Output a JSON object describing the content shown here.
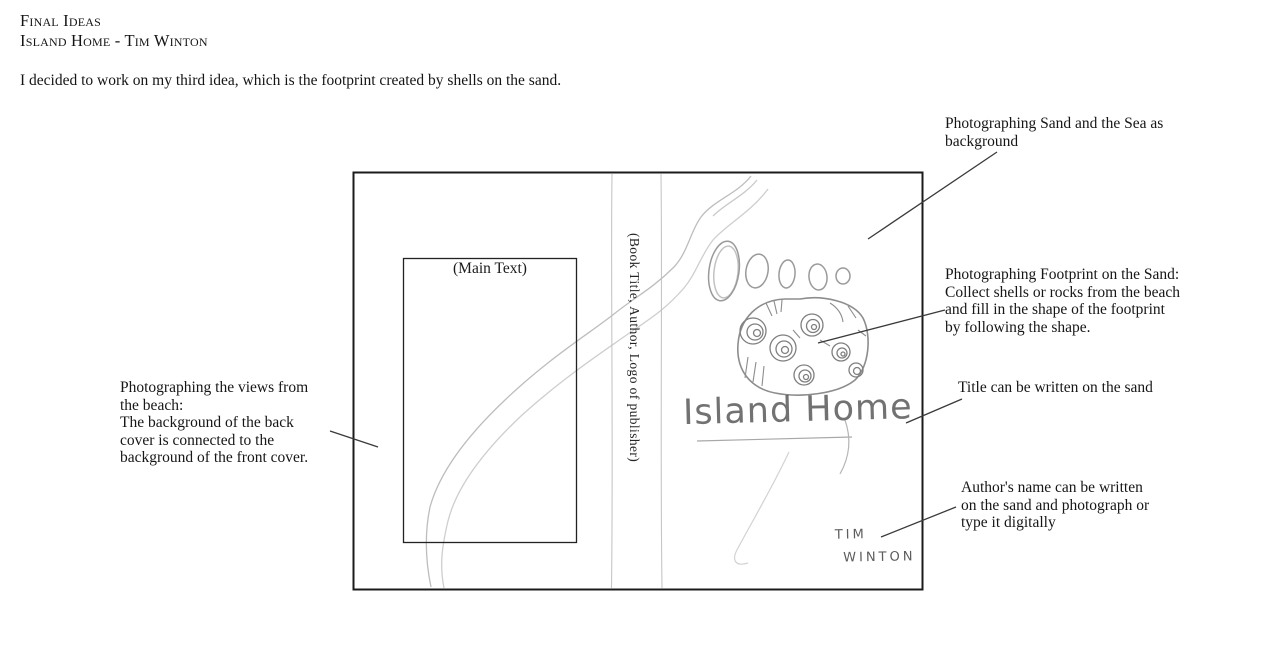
{
  "header": {
    "line1": "Final Ideas",
    "line2": "Island Home - Tim Winton"
  },
  "intro": "I decided to work on my third idea, which is the footprint created by shells on the sand.",
  "book": {
    "back_cover_label": "(Main Text)",
    "spine_label": "(Book Title, Author, Logo of publisher)",
    "title_handwritten": "Island Home",
    "author_line1": "TIM",
    "author_line2": "WINTON"
  },
  "annotations": {
    "sand_sea": {
      "lines": [
        "Photographing Sand and the Sea as",
        "background"
      ]
    },
    "footprint": {
      "lines": [
        "Photographing Footprint on the Sand:",
        "Collect shells or rocks from the beach",
        "and fill in the shape of the footprint",
        "by following the shape."
      ]
    },
    "title_note": {
      "lines": [
        "Title can be written on the sand"
      ]
    },
    "author_note": {
      "lines": [
        "Author's name can be written",
        "on the sand and photograph or",
        "type it digitally"
      ]
    },
    "views_note": {
      "lines": [
        "Photographing the views from",
        "the beach:",
        "The background of the back",
        "cover is connected to the",
        "background of the front cover."
      ]
    }
  },
  "colors": {
    "ink": "#1c1c1c",
    "book_outline": "#1b1b1b",
    "leader_line": "#3a3a3a",
    "pencil_light": "#c3c3c3",
    "pencil_mid": "#9a9a9a",
    "handwriting": "#5a5a5a",
    "background": "#ffffff"
  }
}
